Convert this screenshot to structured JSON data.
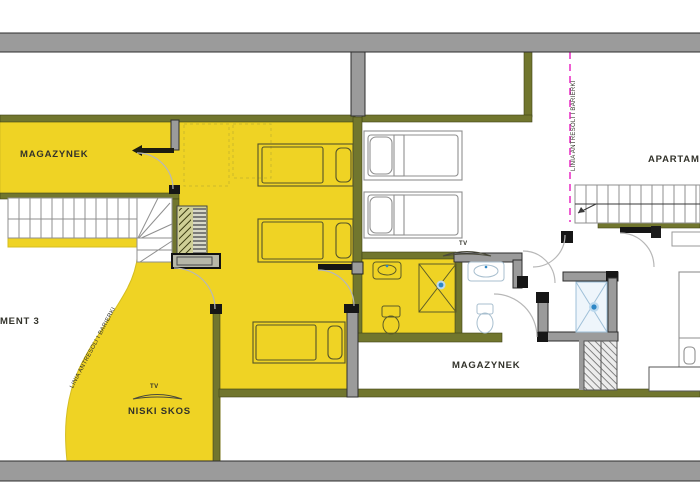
{
  "document": {
    "type": "apartment-floor-plan"
  },
  "labels": {
    "storage_top": "MAGAZYNEK",
    "storage_bottom": "MAGAZYNEK",
    "apartment_left": "APARTAMENT 3",
    "apartment_right": "APARTAMENT",
    "low_slope": "NISKI SKOS",
    "tv": "TV",
    "mezzanine_line": "LINIA ANTRESOLI I BARIERKI"
  },
  "colors": {
    "apartment_highlight": "#EFD324",
    "wall_olive": "#71762E",
    "wall_gray": "#9B9B9B",
    "mezzanine_line_magenta": "#EE5ED2",
    "shower_accent_blue": "#2D86C5",
    "label_text": "#32322A"
  }
}
